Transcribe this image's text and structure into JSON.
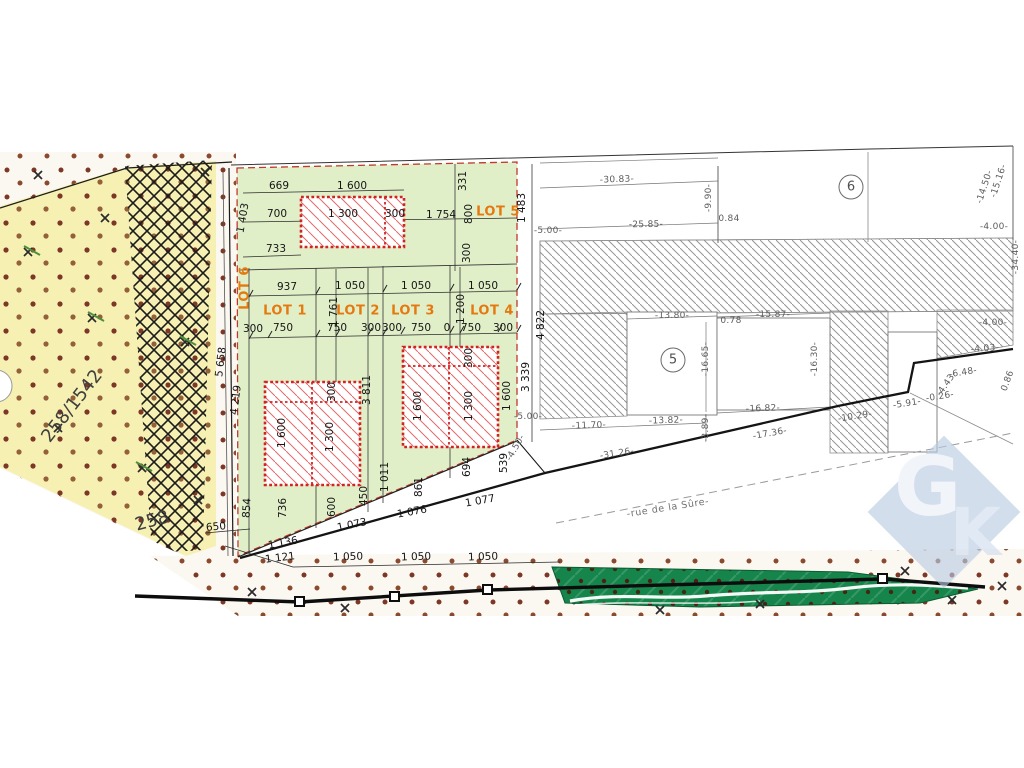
{
  "colors": {
    "lot_green": "#e1efc9",
    "parcel_yellow": "#f6f0b2",
    "building_red": "#d42222",
    "lot_label_orange": "#e5790f",
    "hedge_green": "#15854b",
    "logo_blue": "#b9cbe3",
    "dot_brown": "#7c3726"
  },
  "logo": {
    "letter_g": "G",
    "letter_k": "K"
  },
  "street": {
    "name": "-rue de la Sûre-"
  },
  "annotations": [
    {
      "t": "669",
      "x": 279,
      "y": 186,
      "r": 0,
      "k": "dim"
    },
    {
      "t": "1 600",
      "x": 352,
      "y": 186,
      "r": 0,
      "k": "dim"
    },
    {
      "t": "700",
      "x": 277,
      "y": 214,
      "r": 0,
      "k": "dim"
    },
    {
      "t": "1 300",
      "x": 343,
      "y": 214,
      "r": 0,
      "k": "dim"
    },
    {
      "t": "300",
      "x": 395,
      "y": 214,
      "r": 0,
      "k": "dim"
    },
    {
      "t": "1 754",
      "x": 441,
      "y": 215,
      "r": 0,
      "k": "dim"
    },
    {
      "t": "733",
      "x": 276,
      "y": 249,
      "r": 0,
      "k": "dim"
    },
    {
      "t": "937",
      "x": 287,
      "y": 287,
      "r": 0,
      "k": "dim"
    },
    {
      "t": "1 050",
      "x": 350,
      "y": 286,
      "r": 0,
      "k": "dim"
    },
    {
      "t": "1 050",
      "x": 416,
      "y": 286,
      "r": 0,
      "k": "dim"
    },
    {
      "t": "1 050",
      "x": 483,
      "y": 286,
      "r": 0,
      "k": "dim"
    },
    {
      "t": "300",
      "x": 253,
      "y": 329,
      "r": 0,
      "k": "dim"
    },
    {
      "t": "750",
      "x": 283,
      "y": 328,
      "r": 0,
      "k": "dim"
    },
    {
      "t": "750",
      "x": 337,
      "y": 328,
      "r": 0,
      "k": "dim"
    },
    {
      "t": "300",
      "x": 371,
      "y": 328,
      "r": 0,
      "k": "dim"
    },
    {
      "t": "300",
      "x": 392,
      "y": 328,
      "r": 0,
      "k": "dim"
    },
    {
      "t": "750",
      "x": 421,
      "y": 328,
      "r": 0,
      "k": "dim"
    },
    {
      "t": "0",
      "x": 447,
      "y": 328,
      "r": 0,
      "k": "dim"
    },
    {
      "t": "750",
      "x": 471,
      "y": 328,
      "r": 0,
      "k": "dim"
    },
    {
      "t": "300",
      "x": 503,
      "y": 328,
      "r": 0,
      "k": "dim"
    },
    {
      "t": "331",
      "x": 463,
      "y": 181,
      "r": -90,
      "k": "dim"
    },
    {
      "t": "800",
      "x": 469,
      "y": 214,
      "r": -90,
      "k": "dim"
    },
    {
      "t": "300",
      "x": 467,
      "y": 253,
      "r": -90,
      "k": "dim"
    },
    {
      "t": "1 483",
      "x": 522,
      "y": 208,
      "r": -90,
      "k": "dim"
    },
    {
      "t": "1 403",
      "x": 243,
      "y": 218,
      "r": -80,
      "k": "dim"
    },
    {
      "t": "5 658",
      "x": 221,
      "y": 362,
      "r": -83,
      "k": "dim"
    },
    {
      "t": "4 219",
      "x": 236,
      "y": 400,
      "r": -83,
      "k": "dim"
    },
    {
      "t": "1 761",
      "x": 334,
      "y": 312,
      "r": -90,
      "k": "dim"
    },
    {
      "t": "1 200",
      "x": 461,
      "y": 309,
      "r": -90,
      "k": "dim"
    },
    {
      "t": "3 811",
      "x": 367,
      "y": 390,
      "r": -90,
      "k": "dim"
    },
    {
      "t": "300",
      "x": 332,
      "y": 392,
      "r": -90,
      "k": "dim"
    },
    {
      "t": "1 600",
      "x": 282,
      "y": 433,
      "r": -90,
      "k": "dim"
    },
    {
      "t": "1 300",
      "x": 330,
      "y": 437,
      "r": -90,
      "k": "dim"
    },
    {
      "t": "300",
      "x": 469,
      "y": 358,
      "r": -90,
      "k": "dim"
    },
    {
      "t": "1 600",
      "x": 418,
      "y": 406,
      "r": -90,
      "k": "dim"
    },
    {
      "t": "1 300",
      "x": 469,
      "y": 406,
      "r": -90,
      "k": "dim"
    },
    {
      "t": "1 600",
      "x": 507,
      "y": 396,
      "r": -90,
      "k": "dim"
    },
    {
      "t": "4 822",
      "x": 541,
      "y": 325,
      "r": -90,
      "k": "dim"
    },
    {
      "t": "3 339",
      "x": 526,
      "y": 377,
      "r": -90,
      "k": "dim"
    },
    {
      "t": "854",
      "x": 247,
      "y": 508,
      "r": -87,
      "k": "dim"
    },
    {
      "t": "736",
      "x": 283,
      "y": 508,
      "r": -90,
      "k": "dim"
    },
    {
      "t": "600",
      "x": 332,
      "y": 507,
      "r": -90,
      "k": "dim"
    },
    {
      "t": "450",
      "x": 364,
      "y": 496,
      "r": -90,
      "k": "dim"
    },
    {
      "t": "1 011",
      "x": 385,
      "y": 477,
      "r": -90,
      "k": "dim"
    },
    {
      "t": "861",
      "x": 419,
      "y": 487,
      "r": -90,
      "k": "dim"
    },
    {
      "t": "694",
      "x": 467,
      "y": 467,
      "r": -90,
      "k": "dim"
    },
    {
      "t": "539",
      "x": 504,
      "y": 463,
      "r": -90,
      "k": "dim"
    },
    {
      "t": "650",
      "x": 216,
      "y": 527,
      "r": -5,
      "k": "dim"
    },
    {
      "t": "1 136",
      "x": 283,
      "y": 543,
      "r": -10,
      "k": "dim"
    },
    {
      "t": "1 121",
      "x": 280,
      "y": 558,
      "r": -7,
      "k": "dim"
    },
    {
      "t": "1 073",
      "x": 352,
      "y": 525,
      "r": -12,
      "k": "dim"
    },
    {
      "t": "1 076",
      "x": 412,
      "y": 512,
      "r": -10,
      "k": "dim"
    },
    {
      "t": "1 077",
      "x": 480,
      "y": 501,
      "r": -10,
      "k": "dim"
    },
    {
      "t": "1 050",
      "x": 348,
      "y": 557,
      "r": -2,
      "k": "dim"
    },
    {
      "t": "1 050",
      "x": 416,
      "y": 557,
      "r": -2,
      "k": "dim"
    },
    {
      "t": "1 050",
      "x": 483,
      "y": 557,
      "r": -2,
      "k": "dim"
    },
    {
      "t": "LOT 1",
      "x": 285,
      "y": 311,
      "r": 0,
      "k": "lot"
    },
    {
      "t": "LOT 2",
      "x": 358,
      "y": 311,
      "r": 0,
      "k": "lot"
    },
    {
      "t": "LOT 3",
      "x": 413,
      "y": 311,
      "r": 0,
      "k": "lot"
    },
    {
      "t": "LOT 4",
      "x": 492,
      "y": 311,
      "r": 0,
      "k": "lot"
    },
    {
      "t": "LOT 5",
      "x": 498,
      "y": 212,
      "r": 0,
      "k": "lot"
    },
    {
      "t": "LOT 6",
      "x": 245,
      "y": 288,
      "r": -90,
      "k": "lot"
    },
    {
      "t": "-30.83-",
      "x": 617,
      "y": 180,
      "r": -2,
      "k": "gray"
    },
    {
      "t": "-9.90-",
      "x": 709,
      "y": 198,
      "r": -90,
      "k": "gray"
    },
    {
      "t": "0.84",
      "x": 729,
      "y": 219,
      "r": 0,
      "k": "gray"
    },
    {
      "t": "-25.85-",
      "x": 646,
      "y": 225,
      "r": -1,
      "k": "gray"
    },
    {
      "t": "-15.16-",
      "x": 999,
      "y": 181,
      "r": -72,
      "k": "gray"
    },
    {
      "t": "-14.50-",
      "x": 985,
      "y": 187,
      "r": -72,
      "k": "gray"
    },
    {
      "t": "-4.00-",
      "x": 994,
      "y": 227,
      "r": 0,
      "k": "gray"
    },
    {
      "t": "-34.40-",
      "x": 1016,
      "y": 257,
      "r": -90,
      "k": "gray"
    },
    {
      "t": "-4.00-",
      "x": 993,
      "y": 323,
      "r": 0,
      "k": "gray"
    },
    {
      "t": "-13.80-",
      "x": 672,
      "y": 316,
      "r": 0,
      "k": "gray"
    },
    {
      "t": "0.78",
      "x": 731,
      "y": 321,
      "r": 0,
      "k": "gray"
    },
    {
      "t": "-15.87-",
      "x": 773,
      "y": 315,
      "r": 0,
      "k": "gray"
    },
    {
      "t": "-16.65-",
      "x": 706,
      "y": 359,
      "r": -90,
      "k": "gray"
    },
    {
      "t": "-16.30-",
      "x": 815,
      "y": 359,
      "r": -90,
      "k": "gray"
    },
    {
      "t": "-16.82-",
      "x": 763,
      "y": 409,
      "r": -2,
      "k": "gray"
    },
    {
      "t": "-11.70-",
      "x": 589,
      "y": 426,
      "r": -2,
      "k": "gray"
    },
    {
      "t": "-13.82-",
      "x": 666,
      "y": 421,
      "r": -2,
      "k": "gray"
    },
    {
      "t": "-3.89-",
      "x": 706,
      "y": 428,
      "r": -90,
      "k": "gray"
    },
    {
      "t": "-17.36-",
      "x": 770,
      "y": 434,
      "r": -10,
      "k": "gray"
    },
    {
      "t": "-31.26-",
      "x": 617,
      "y": 454,
      "r": -9,
      "k": "gray"
    },
    {
      "t": "-10.29-",
      "x": 855,
      "y": 417,
      "r": -9,
      "k": "gray"
    },
    {
      "t": "-5.91-",
      "x": 907,
      "y": 404,
      "r": -9,
      "k": "gray"
    },
    {
      "t": "-0.26-",
      "x": 940,
      "y": 397,
      "r": -9,
      "k": "gray"
    },
    {
      "t": "-6.48-",
      "x": 963,
      "y": 373,
      "r": -9,
      "k": "gray"
    },
    {
      "t": "-4.43-",
      "x": 947,
      "y": 384,
      "r": -55,
      "k": "gray"
    },
    {
      "t": "-4.03-",
      "x": 985,
      "y": 349,
      "r": -4,
      "k": "gray"
    },
    {
      "t": "0.86",
      "x": 1008,
      "y": 381,
      "r": -70,
      "k": "gray"
    },
    {
      "t": "-5.00-",
      "x": 548,
      "y": 231,
      "r": 0,
      "k": "gray"
    },
    {
      "t": "-5.00-",
      "x": 528,
      "y": 417,
      "r": 0,
      "k": "gray"
    },
    {
      "t": "-4.50-",
      "x": 516,
      "y": 448,
      "r": -60,
      "k": "gray"
    },
    {
      "t": "258/1542",
      "x": 72,
      "y": 406,
      "r": -52,
      "k": "big"
    },
    {
      "t": "258",
      "x": 152,
      "y": 521,
      "r": -15,
      "k": "big"
    },
    {
      "t": "6",
      "x": 851,
      "y": 187,
      "r": 0,
      "k": "circle"
    },
    {
      "t": "5",
      "x": 673,
      "y": 360,
      "r": 0,
      "k": "circle"
    },
    {
      "t": "-rue de la Sûre-",
      "x": 668,
      "y": 508,
      "r": -9,
      "k": "street"
    }
  ]
}
